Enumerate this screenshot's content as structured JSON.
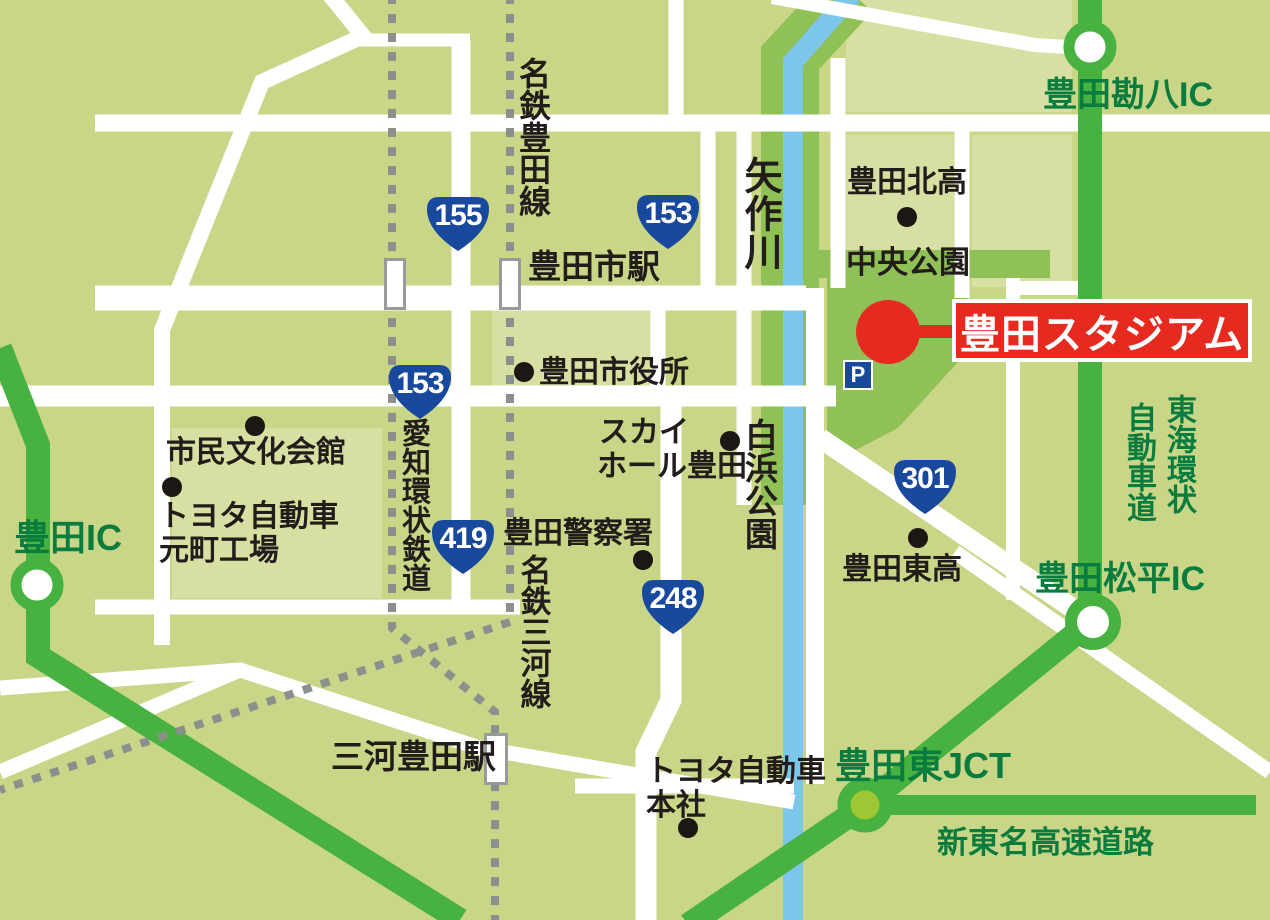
{
  "colors": {
    "background": "#c9d687",
    "block_light": "#d7e0a2",
    "park_green": "#8fc156",
    "highway_green": "#47b23f",
    "jct_fill": "#9dc833",
    "river_blue": "#7cc6eb",
    "road_white": "#ffffff",
    "railway_gray": "#8b908d",
    "route_badge_blue": "#19499c",
    "accent_red": "#e62a20",
    "highway_text_green": "#0a7c3e"
  },
  "callout": {
    "label": "豊田スタジアム",
    "parking": "P"
  },
  "badges": [
    {
      "number": "155"
    },
    {
      "number": "153"
    },
    {
      "number": "153"
    },
    {
      "number": "419"
    },
    {
      "number": "301"
    },
    {
      "number": "248"
    }
  ],
  "stations": [
    {
      "name": "豊田市駅"
    },
    {
      "name": "三河豊田駅"
    }
  ],
  "railways": [
    {
      "name": "名鉄豊田線"
    },
    {
      "name": "愛知環状鉄道"
    },
    {
      "name": "名鉄三河線"
    }
  ],
  "river": {
    "name": "矢作川"
  },
  "parks": [
    {
      "name": "中央公園"
    },
    {
      "name": "白浜公園"
    }
  ],
  "pois": [
    {
      "name": "市民文化会館"
    },
    {
      "name": "トヨタ自動車",
      "name2": "元町工場"
    },
    {
      "name": "豊田市役所"
    },
    {
      "name": "スカイ",
      "name2": "ホール豊田"
    },
    {
      "name": "豊田警察署"
    },
    {
      "name": "豊田北高"
    },
    {
      "name": "豊田東高"
    },
    {
      "name": "トヨタ自動車",
      "name2": "本社"
    }
  ],
  "highways": {
    "ics": [
      {
        "name": "豊田IC"
      },
      {
        "name": "豊田勘八IC"
      },
      {
        "name": "豊田松平IC"
      }
    ],
    "jct": {
      "name": "豊田東JCT"
    },
    "kanjo_vertical": {
      "col_right": "東海環状",
      "col_left": "自動車道"
    },
    "shin_tomei": {
      "name": "新東名高速道路"
    }
  }
}
